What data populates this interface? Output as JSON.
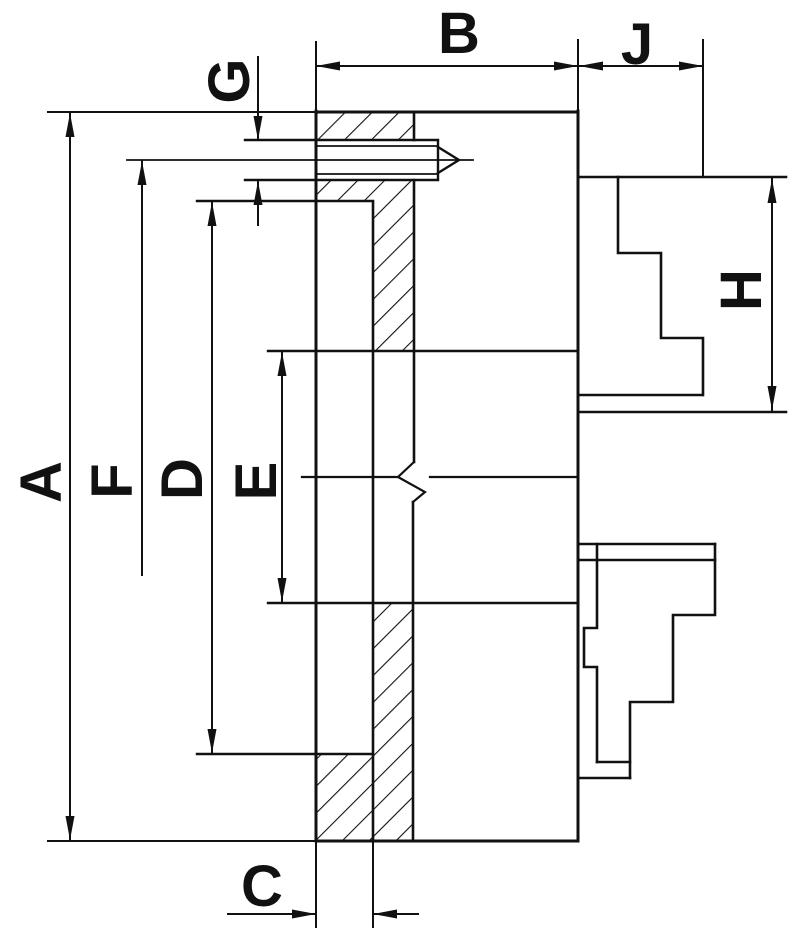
{
  "colors": {
    "ink": "#111111",
    "background": "#ffffff"
  },
  "labels": {
    "A": "A",
    "B": "B",
    "C": "C",
    "D": "D",
    "E": "E",
    "F": "F",
    "G": "G",
    "H": "H",
    "J": "J"
  }
}
